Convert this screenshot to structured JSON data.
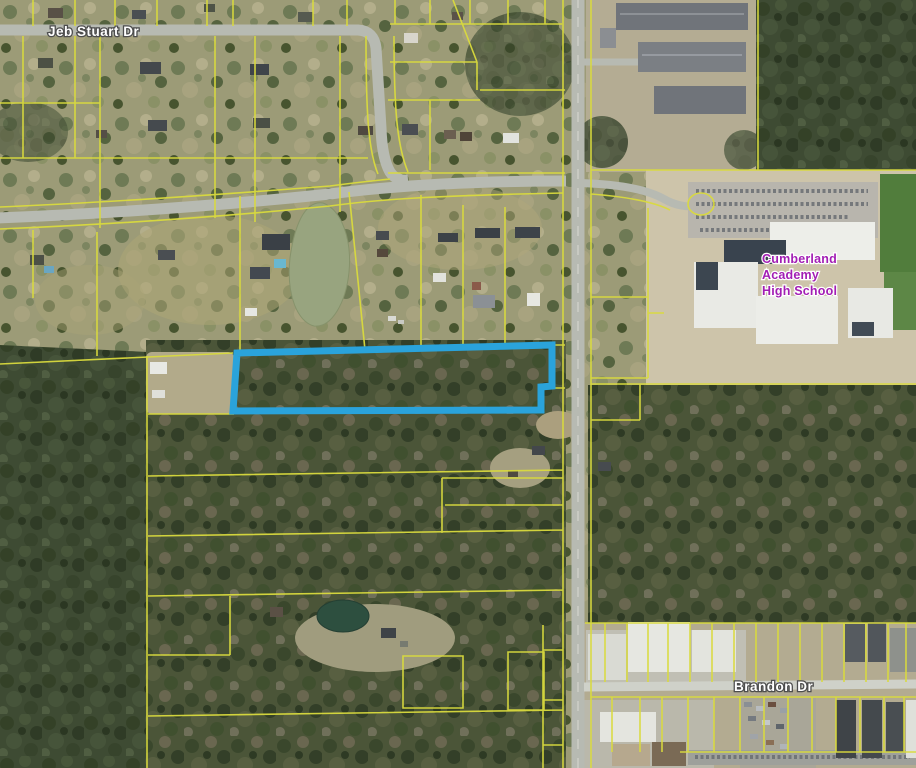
{
  "map": {
    "description": "Aerial parcel map with highlighted subject parcel",
    "street_labels": [
      {
        "id": "jeb-stuart-dr",
        "text": "Jeb Stuart Dr"
      },
      {
        "id": "brandon-dr",
        "text": "Brandon Dr"
      }
    ],
    "school_label": {
      "line1": "Cumberland",
      "line2": "Academy",
      "line3": "High School"
    },
    "highlight_parcel": {
      "points": "237,353 552,345 552,386 541,387 541,410 233,411",
      "stroke_color": "#2aa3db"
    },
    "colors": {
      "parcel_line": "#d9da3d",
      "highlight": "#2aa3db",
      "street_label_fill": "#ffffff",
      "street_label_outline": "#4d4d4d",
      "school_label_fill": "#a21db4",
      "road_fill": "#b7bab2",
      "forest": "#3e4b33",
      "field": "#cdc4aa",
      "pond": "#98a47f"
    }
  }
}
